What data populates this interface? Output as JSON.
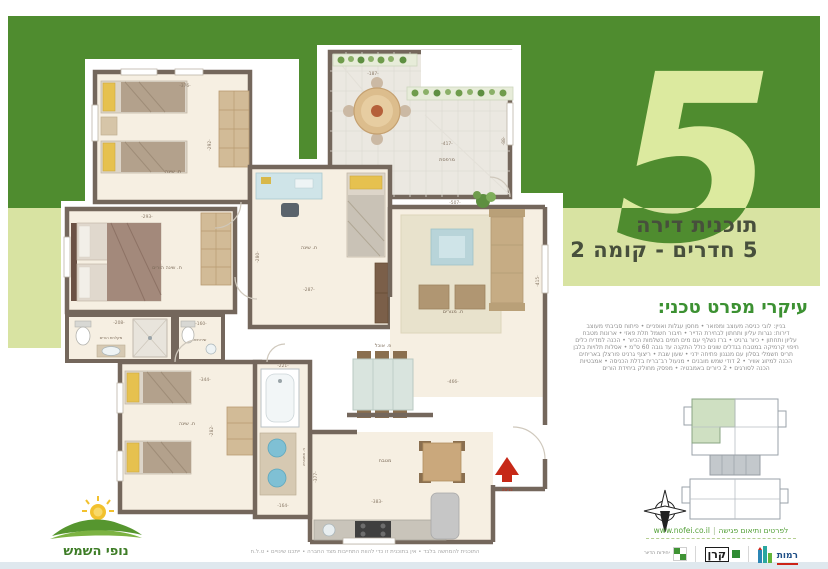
{
  "header": {
    "big_number": "5",
    "title_line1": "תוכנית דירה",
    "title_line2": "5 חדרים - קומה 2"
  },
  "spec": {
    "heading": "עיקרי מפרט טכני:",
    "lines": [
      "בניין: לובי כניסה מעוצב ומפואר • מחסן עגלות ואופניים • פיתוח סביבתי מעוצב",
      "דירות: נגרות עליון ותחתון לבחירת הדייר • חיבור חשמל תלת פאזי • ארונות מטבח",
      "עליון ותחתון • כיור גרניט • ברז נשלף עם מים חמים בשלמות הכיור • הכנה למדיח כלים",
      "חיפוי קרמיקה במטבח בגדלים שונים כולל התקנה עד גובה 60 ס\"מ • אסלות תלויות בלבן",
      "תריס חשמלי בסלון עם מנגנון פתיחה ידני • שעון שבת • ריצוף גרניט פורצלן באריחים",
      "הכנה למיזוג אוויר • 2 דודי שמש מובנים • מנעול רב־בריח בדלת הכניסה • אמבטיות",
      "הכנה לסורגים • 2 כיורים באמבטיה • מפסק מחולק ביחידת הורים"
    ]
  },
  "plan": {
    "rooms": {
      "bedroom_top": {
        "name": "ח. שינה",
        "w": "-376-",
        "h": "-292-"
      },
      "master": {
        "name": "ח. שינה הורים",
        "w": "-293-"
      },
      "bedroom_mid": {
        "name": "ח. שינה",
        "w": "-287-",
        "h": "-280-"
      },
      "bedroom_bottom": {
        "name": "ח. שינה",
        "w": "-344-",
        "h": "-282-"
      },
      "terrace": {
        "name": "מרפסת",
        "w": "-417-",
        "top": "-187-",
        "h": "-88-"
      },
      "living": {
        "name": "ח. מגורים",
        "w": "-507-",
        "h": "-415-"
      },
      "dining": {
        "name": "פ. אוכל",
        "w": "-466-"
      },
      "kitchen": {
        "name": "מטבח",
        "w": "-383-",
        "h": "-377-"
      },
      "bath": {
        "name": "ח. אמבטיה",
        "w": "-221-",
        "h": "-164-"
      },
      "shower_parents": {
        "name": "מקלחת הורים",
        "w": "-208-"
      },
      "wc": {
        "name": "שירותים",
        "w": "-160-"
      },
      "entrance": {
        "name": "כניסה"
      }
    }
  },
  "footer": {
    "website": "www.nofei.co.il",
    "contact": "לפרטים ותיאום פגישה",
    "disclaimer": "התוכנית להמחשה בלבד • אין בתוכנית זו כדי להוות התחייבות מצד החברה • ייתכנו שינויים • ט.ל.ח",
    "brand": "נופי השמש",
    "logos": {
      "units": "יחידות הדיור",
      "keren": "קרן",
      "ramot": "רמות"
    }
  },
  "colors": {
    "band_dark": "#4f8c2f",
    "band_light": "#d8e3a2",
    "accent_green": "#3c9132",
    "entrance_red": "#c62817"
  }
}
